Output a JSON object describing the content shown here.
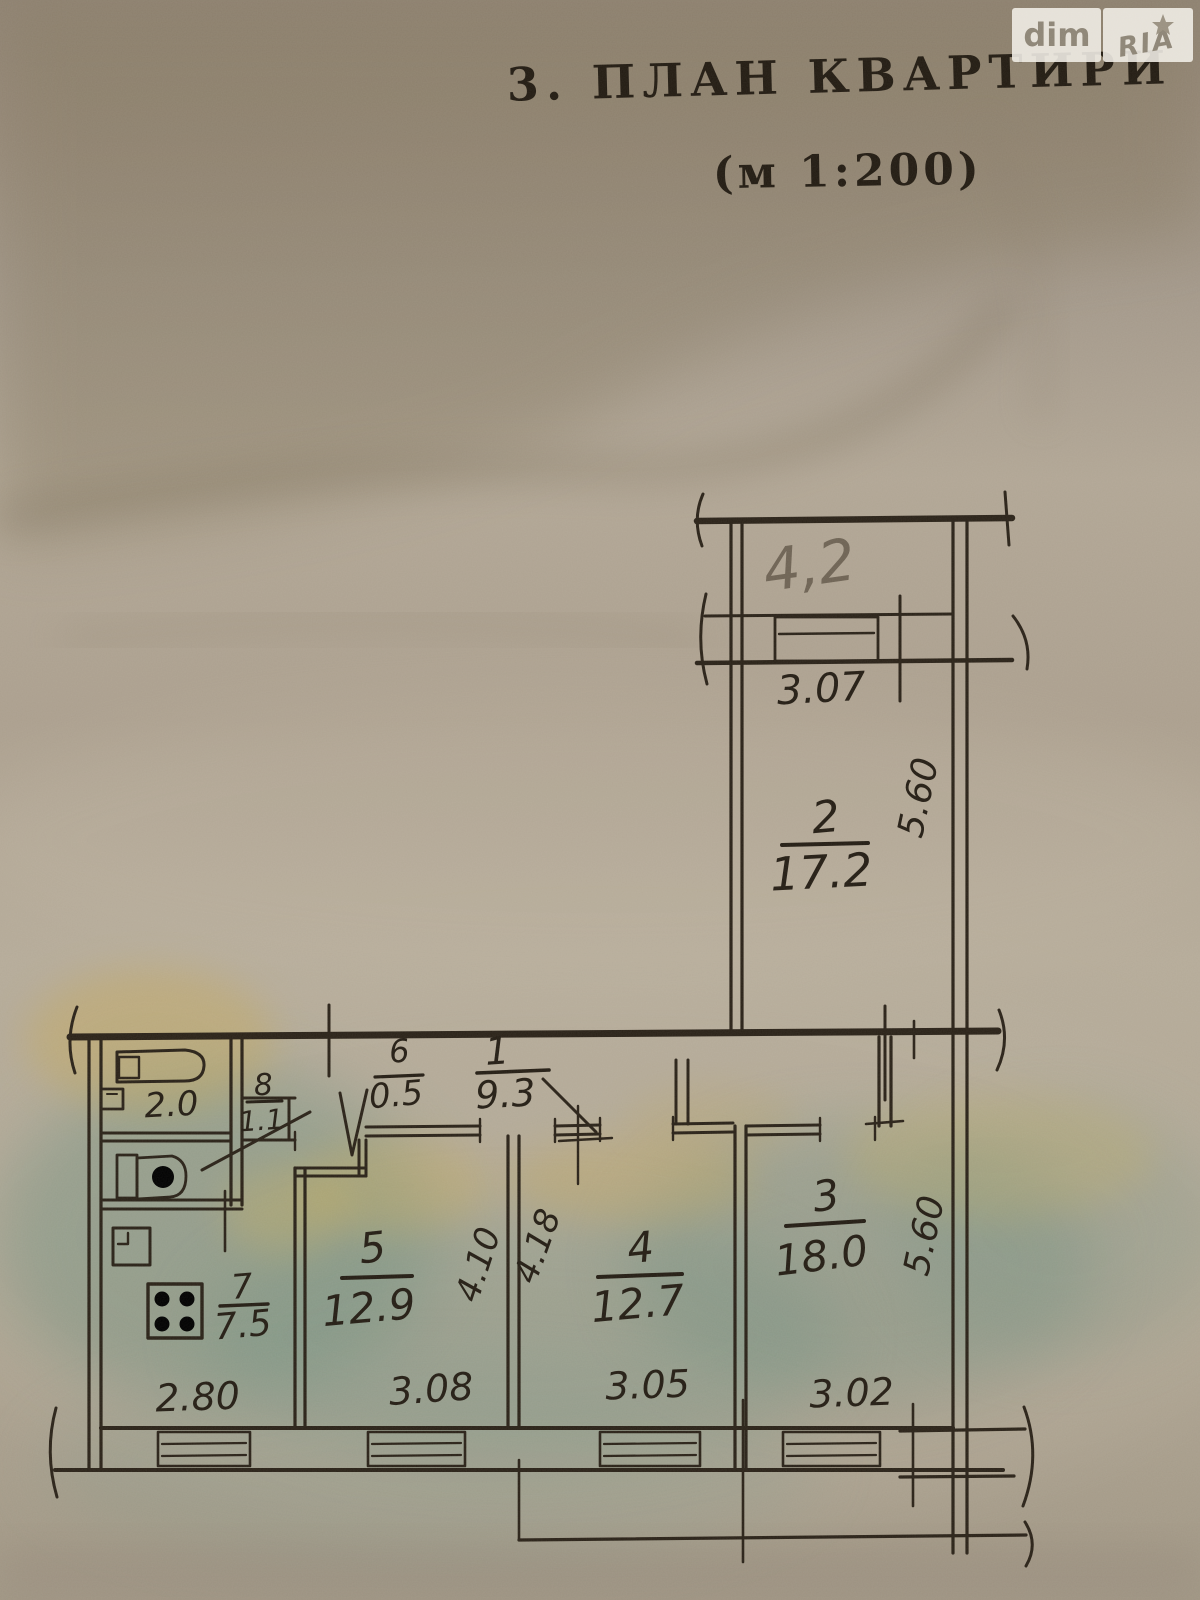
{
  "header": {
    "title": "3. ПЛАН КВАРТИРИ",
    "scale": "(м 1:200)"
  },
  "watermark": {
    "left": "dim",
    "right": "RIA"
  },
  "plan": {
    "balcony": {
      "area": "4,2",
      "width": "3.07"
    },
    "rooms": {
      "r1": {
        "num": "1",
        "area": "9.3"
      },
      "r2": {
        "num": "2",
        "area": "17.2"
      },
      "r3": {
        "num": "3",
        "area": "18.0"
      },
      "r4": {
        "num": "4",
        "area": "12.7"
      },
      "r5": {
        "num": "5",
        "area": "12.9"
      },
      "r6": {
        "num": "6",
        "area": "0.5"
      },
      "r7": {
        "num": "7",
        "area": "7.5"
      },
      "r8": {
        "num": "8",
        "area": "1.1"
      }
    },
    "bathroom_area": "2.0",
    "dims": {
      "d280": "2.80",
      "d308": "3.08",
      "d305": "3.05",
      "d302": "3.02",
      "d560_top": "5.60",
      "d560_bottom": "5.60",
      "d410": "4.10",
      "d418": "4.18"
    }
  }
}
